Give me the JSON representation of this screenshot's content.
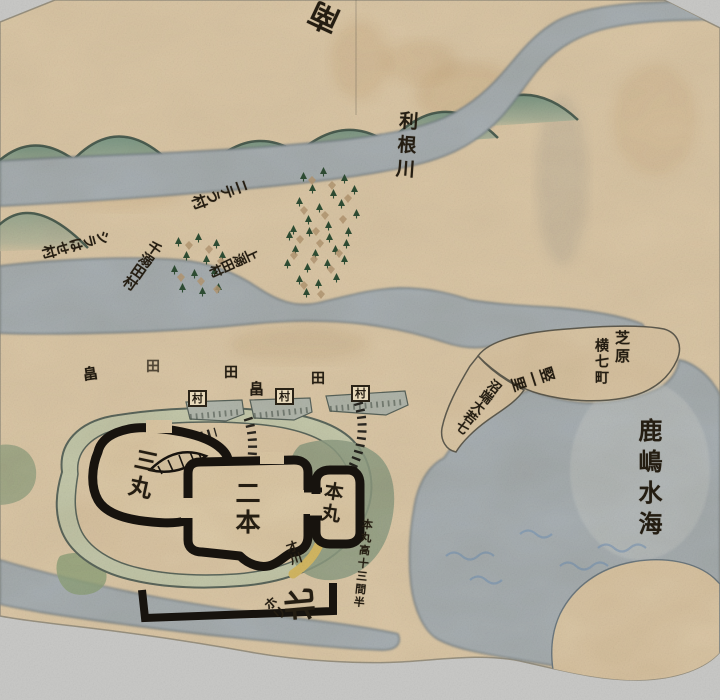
{
  "labels": {
    "compass_south": "南",
    "compass_north": "北",
    "river_tone": "利根川",
    "village_top": "ニテう村",
    "village_left": "シラはせ村",
    "village_mid": "千溺田村",
    "village_right": "上溺田村",
    "shibahara": "芝原",
    "yoko_shichicho": "横七町",
    "tate_ichiri": "竪一里",
    "numabata_note": "沼端大若七",
    "kashima_mizuumi": "鹿嶋水海",
    "sanmaru": "三丸",
    "ninomaru": "二本",
    "honmaru": "本丸",
    "honmaru_height_note": "本丸高十三間半",
    "stream_saikawa": "才川",
    "moat_hori": "ホリ",
    "fields": [
      "畠",
      "田",
      "田",
      "畠",
      "田"
    ],
    "village_boxes": [
      "村",
      "村",
      "村"
    ]
  },
  "colors": {
    "paper": "#dcc8a7",
    "water": "#a9b1b5",
    "mountain_green": "#7e9a88",
    "castle_wall_ink": "#17130e",
    "moat_green": "#90a086",
    "stream_yellow": "#d8bd66",
    "text_ink": "#241d12",
    "backdrop": "#c9c9c7",
    "faded_blue_marks": "#6f92ba"
  }
}
